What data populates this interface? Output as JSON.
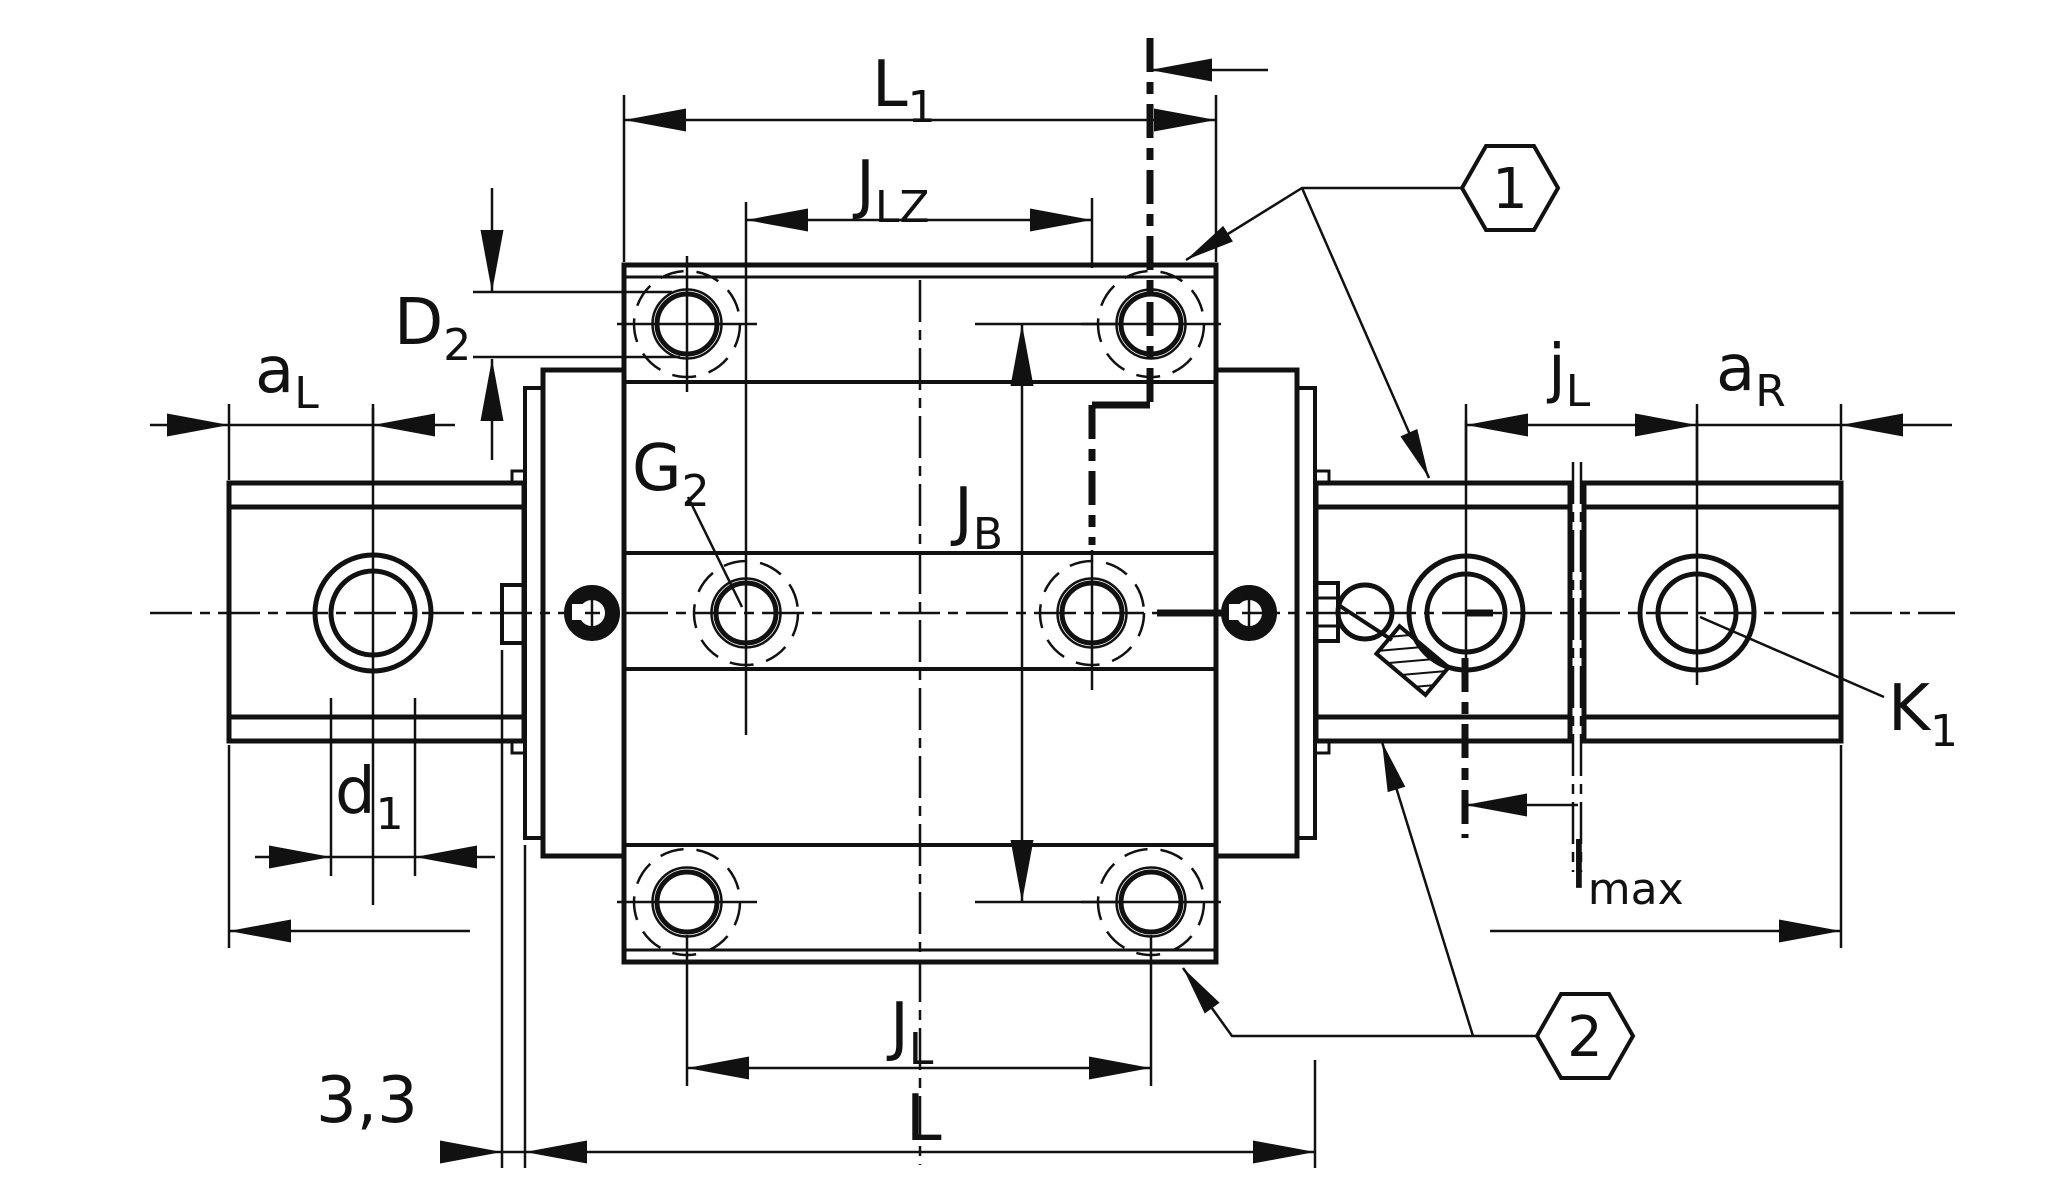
{
  "drawing": {
    "type": "technical dimension drawing",
    "subject": "linear recirculating ball bearing and guideway assembly, carriage on two-piece rail, plan view",
    "background_color": "#ffffff",
    "line_color": "#111111"
  },
  "dimension_labels": {
    "L1": {
      "main": "L",
      "sub": "1"
    },
    "JLZ": {
      "main": "J",
      "sub": "LZ"
    },
    "D2": {
      "main": "D",
      "sub": "2"
    },
    "aL": {
      "main": "a",
      "sub": "L"
    },
    "G2": {
      "main": "G",
      "sub": "2"
    },
    "JB": {
      "main": "J",
      "sub": "B"
    },
    "jL": {
      "main": "j",
      "sub": "L"
    },
    "aR": {
      "main": "a",
      "sub": "R"
    },
    "K1": {
      "main": "K",
      "sub": "1"
    },
    "d1": {
      "main": "d",
      "sub": "1"
    },
    "lmax": {
      "main": "l",
      "sub": "max"
    },
    "JL": {
      "main": "J",
      "sub": "L"
    },
    "L": {
      "main": "L",
      "sub": ""
    },
    "gap": {
      "main": "3,3",
      "sub": ""
    }
  },
  "callouts": [
    {
      "number": "1"
    },
    {
      "number": "2"
    }
  ]
}
